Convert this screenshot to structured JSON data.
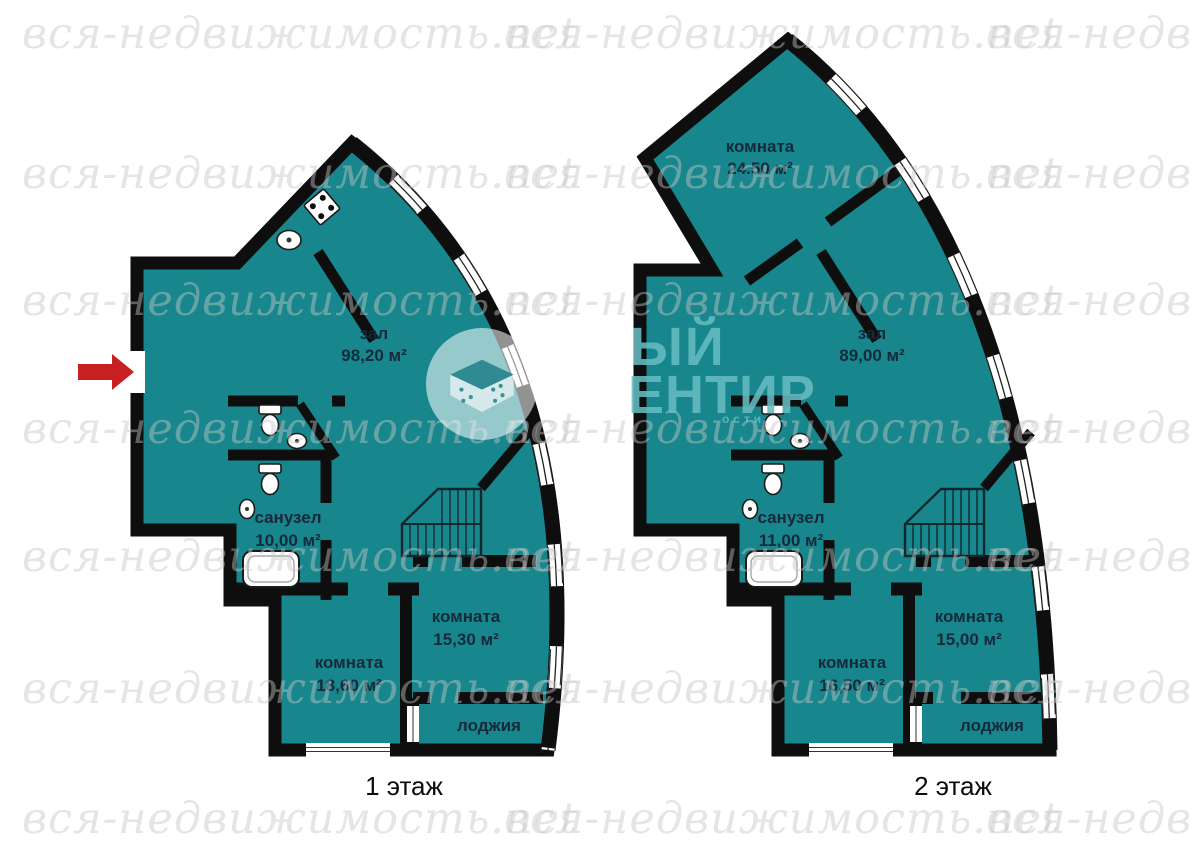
{
  "watermark": {
    "text": "вся-недвижимость.net"
  },
  "logo": {
    "line1": "ЫЙ",
    "line2": "ЕНТИР",
    "subtext": "ости"
  },
  "colors": {
    "room_fill": "#17878d",
    "wall": "#0e0e0e",
    "label": "#15293b",
    "entrance_arrow": "#c81f23",
    "logo_text": "rgba(103,188,194,0.88)"
  },
  "plans": [
    {
      "floor_label": "1 этаж",
      "rooms": {
        "hall": {
          "name": "зал",
          "area": "98,20 м²"
        },
        "bath": {
          "name": "санузел",
          "area": "10,00 м²"
        },
        "bedroom1": {
          "name": "комната",
          "area": "18,60 м²"
        },
        "bedroom2": {
          "name": "комната",
          "area": "15,30 м²"
        },
        "loggia": {
          "name": "лоджия"
        }
      }
    },
    {
      "floor_label": "2 этаж",
      "rooms": {
        "top_room": {
          "name": "комната",
          "area": "24.50 м²"
        },
        "hall": {
          "name": "зал",
          "area": "89,00 м²"
        },
        "bath": {
          "name": "санузел",
          "area": "11,00 м²"
        },
        "bedroom1": {
          "name": "комната",
          "area": "16,50 м²"
        },
        "bedroom2": {
          "name": "комната",
          "area": "15,00 м²"
        },
        "loggia": {
          "name": "лоджия"
        }
      }
    }
  ]
}
